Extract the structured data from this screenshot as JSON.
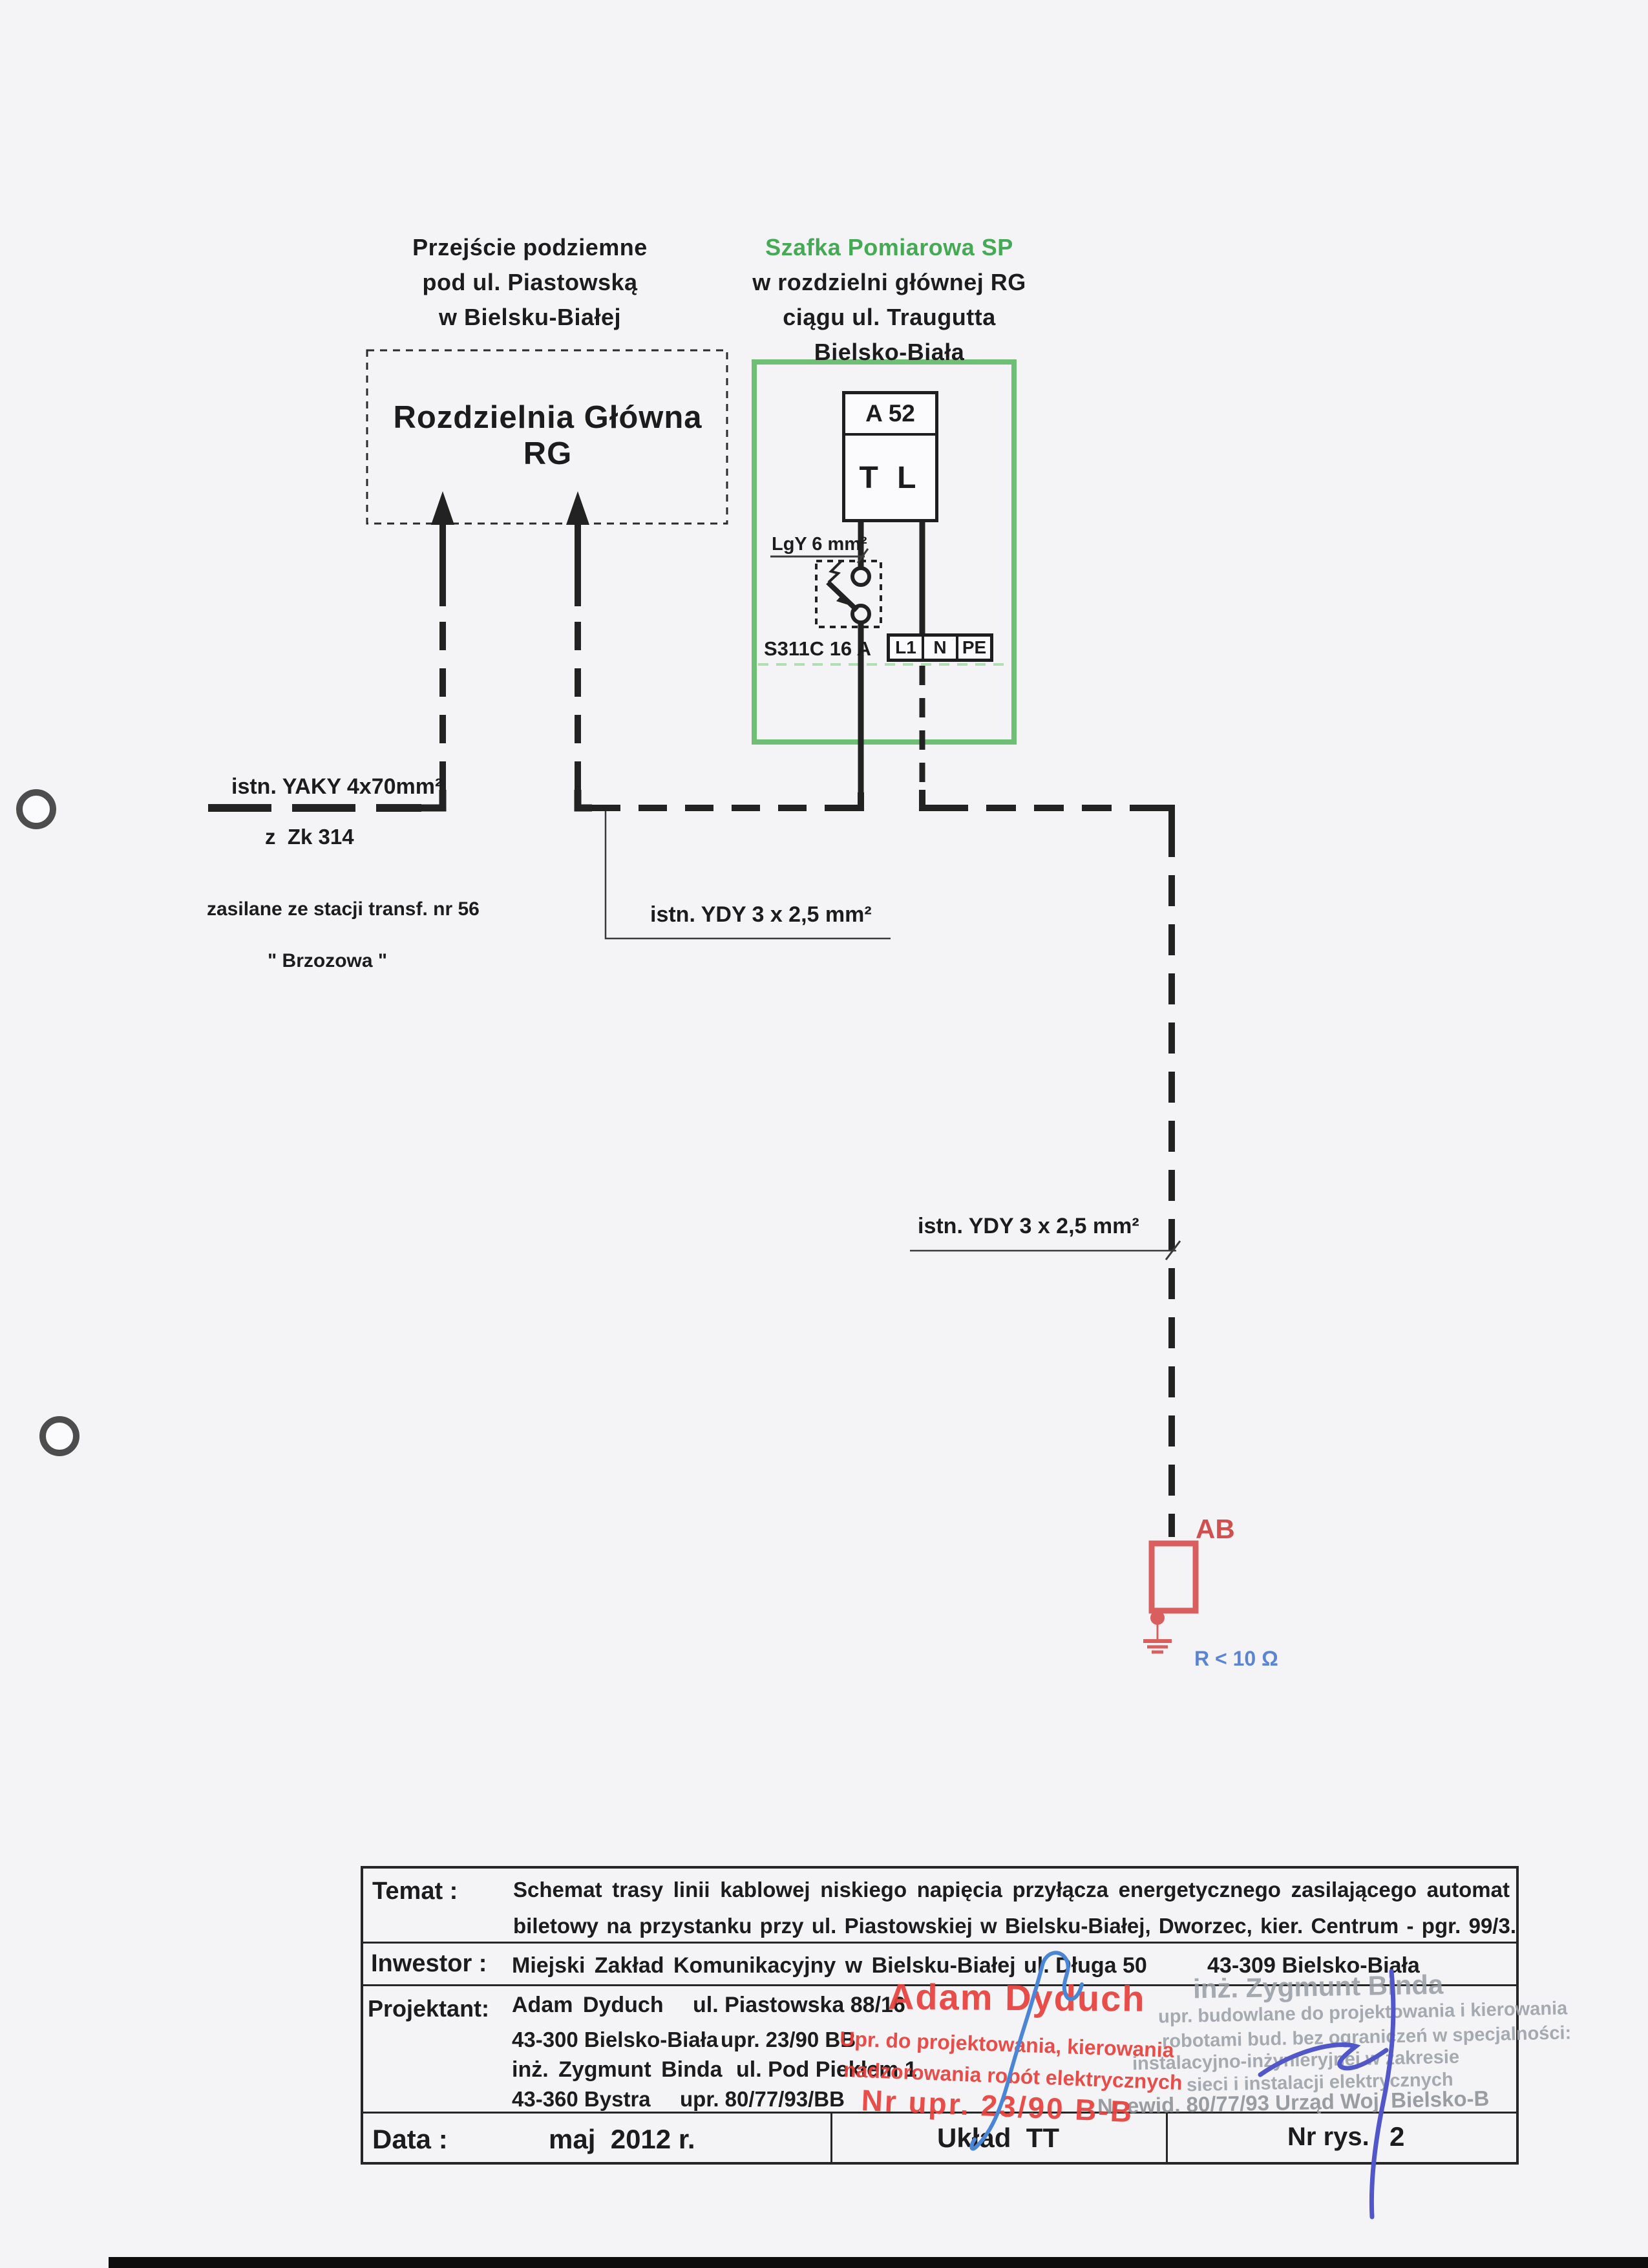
{
  "colors": {
    "paper": "#f4f4f7",
    "ink": "#1e1e1e",
    "green_text": "#45a955",
    "green_border": "#6fbe75",
    "green_dashed_line": "#b2dcb4",
    "red_stamp": "#e8413c",
    "red_device": "#d95f5f",
    "blue_label": "#5b85d3",
    "blue_pen_1": "#4b86d6",
    "blue_pen_2": "#5156c8"
  },
  "headers": {
    "left": {
      "l1": "Przejście podziemne",
      "l2": "pod ul. Piastowską",
      "l3": "w Bielsku-Białej"
    },
    "right": {
      "l1": "Szafka Pomiarowa SP",
      "l2": "w rozdzielni głównej RG",
      "l3": "ciągu ul. Traugutta",
      "l4": "Bielsko-Biała"
    }
  },
  "diagram": {
    "rg_box_title": "Rozdzielnia Główna RG",
    "meter_box": {
      "id": "A 52",
      "device": "T L"
    },
    "wire_label_lgy": "LgY 6 mm²",
    "breaker_label": "S311C 16 A",
    "terminals": {
      "t1": "L1",
      "t2": "N",
      "t3": "PE"
    },
    "yaky": {
      "l1": "istn. YAKY 4x70mm²",
      "l2": "z  Zk 314",
      "l3": "zasilane ze stacji transf. nr 56",
      "l4": "\" Brzozowa \""
    },
    "ydy1": "istn. YDY 3 x 2,5 mm²",
    "ydy2": "istn. YDY 3 x 2,5 mm²",
    "ab": {
      "label": "AB",
      "resistance": "R < 10 Ω"
    }
  },
  "title_block": {
    "temat": {
      "label": "Temat :",
      "line1": "Schemat trasy linii kablowej niskiego napięcia przyłącza energetycznego zasilającego automat",
      "line2": "biletowy na przystanku przy ul. Piastowskiej w Bielsku-Białej, Dworzec, kier. Centrum - pgr. 99/3."
    },
    "inwestor": {
      "label": "Inwestor :",
      "name": "Miejski Zakład Komunikacyjny w Bielsku-Białej",
      "street": "ul. Długa 50",
      "city": "43-309 Bielsko-Biała"
    },
    "projektant": {
      "label": "Projektant:",
      "r1a": "Adam Dyduch",
      "r1b": "ul. Piastowska 88/16",
      "r2a": "43-300 Bielsko-Biała",
      "r2b": "upr. 23/90 BB",
      "r3a": "inż. Zygmunt Binda",
      "r3b": "ul. Pod Piekłem 1",
      "r4a": "43-360 Bystra",
      "r4b": "upr. 80/77/93/BB"
    },
    "data_row": {
      "label": "Data :",
      "value": "maj  2012 r.",
      "uklad": "Układ  TT",
      "nr_rys_label": "Nr rys.",
      "nr_rys_value": "2"
    }
  },
  "stamps": {
    "red": {
      "name": "Adam Dyduch",
      "l2": "Upr. do projektowania, kierowania",
      "l3": "nadzorowania robót elektrycznych",
      "l4": "Nr upr. 23/90 B-B"
    },
    "gray": {
      "l1": "inż. Zygmunt Binda",
      "l2": "upr. budowlane do projektowania i kierowania",
      "l3": "robotami bud. bez ograniczeń w specjalności:",
      "l4": "instalacyjno-inżynieryjnej w zakresie",
      "l5": "sieci i instalacji elektrycznych",
      "l6": "Nr ewid. 80/77/93 Urząd Woj. Bielsko-B"
    }
  }
}
